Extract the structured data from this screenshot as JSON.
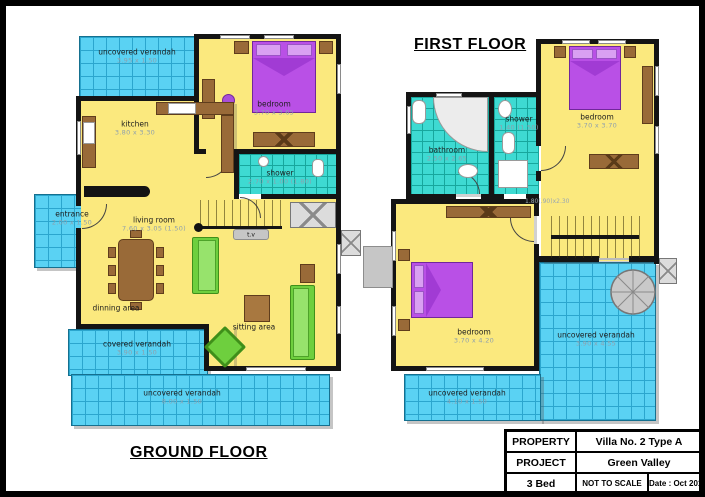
{
  "sheet": {
    "ground_floor": {
      "title": "GROUND FLOOR",
      "verandah_top": {
        "name": "uncovered verandah",
        "dims": "3.95 x 1.50"
      },
      "bedroom": {
        "name": "bedroom",
        "dims": "3.70 x 3.65"
      },
      "kitchen": {
        "name": "kitchen",
        "dims": "3.80 x 3.30"
      },
      "shower": {
        "name": "shower",
        "dims": "2.70 x 1.00 (1.80)"
      },
      "entrance": {
        "name": "entrance",
        "dims": "2.00 x 1.50"
      },
      "living_room": {
        "name": "living room",
        "dims": "7.60 x 3.05 (1.50)"
      },
      "dining_area": {
        "name": "dinning area"
      },
      "sitting_area": {
        "name": "sitting area"
      },
      "tv_unit": {
        "name": "t.v"
      },
      "covered_verandah": {
        "name": "covered verandah",
        "dims": "3.90 x 1.50"
      },
      "uncovered_verandah_bottom": {
        "name": "uncovered verandah",
        "dims": "8.00 x 1.50"
      }
    },
    "first_floor": {
      "title": "FIRST FLOOR",
      "bathroom": {
        "name": "bathroom",
        "dims": "2.50 x 2.65"
      },
      "shower": {
        "name": "shower",
        "dims": "1.40 (1.50)"
      },
      "bedroom_top": {
        "name": "bedroom",
        "dims": "3.70 x 3.70"
      },
      "bedroom_bottom": {
        "name": "bedroom",
        "dims": "3.70 x 4.20"
      },
      "stair_note": "1.80(.90)x2.30",
      "uncovered_verandah_main": {
        "name": "uncovered verandah",
        "dims": "3.90 x 4.55"
      },
      "uncovered_verandah_bottom": {
        "name": "uncovered verandah",
        "dims": "4.10 x 1.50"
      }
    },
    "title_block": {
      "rows": [
        {
          "label": "PROPERTY",
          "value": "Villa No. 2 Type A"
        },
        {
          "label": "PROJECT",
          "value": "Green Valley"
        },
        {
          "label": "3 Bed",
          "scale": "NOT TO SCALE",
          "date": "Date : Oct 2011"
        }
      ]
    },
    "colors": {
      "wall": "#141414",
      "room_fill": "#fbe97e",
      "verandah_fill": "#5ad2f3",
      "verandah_grid": "#2ba6ce",
      "wet_room_fill": "#3edad2",
      "bed": "#b950e6",
      "sofa": "#6ecf3e",
      "wood": "#996a38",
      "fixture_gray": "#c6c6c6"
    }
  }
}
